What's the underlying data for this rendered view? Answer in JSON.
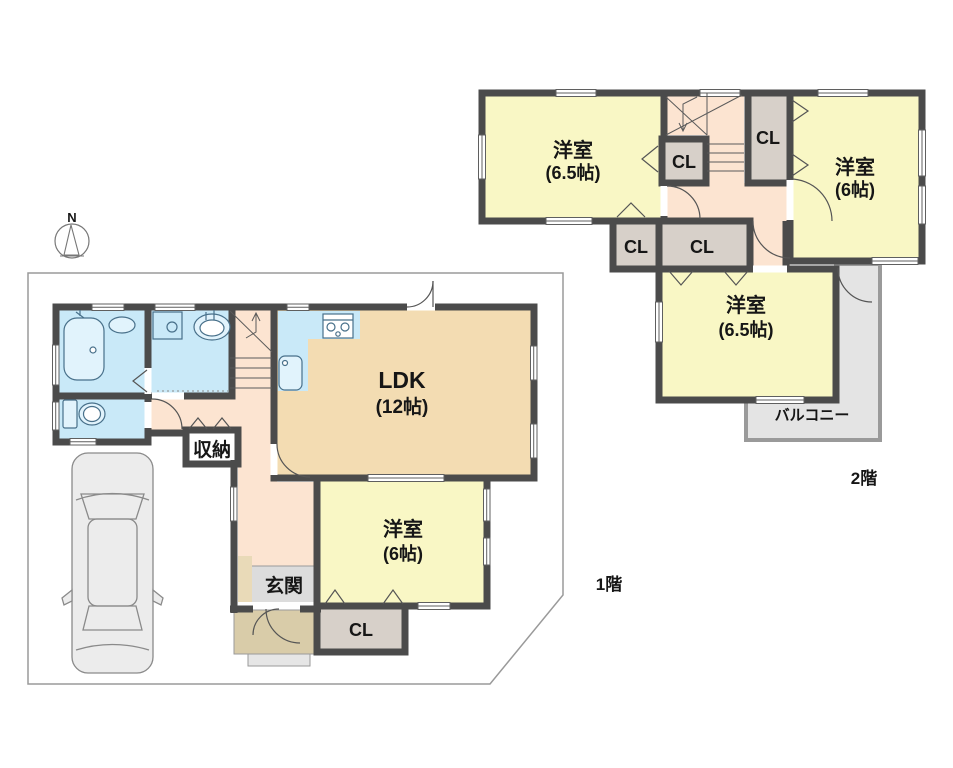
{
  "compass": {
    "north": "N"
  },
  "floor1": {
    "label": "1階",
    "ldk_name": "LDK",
    "ldk_size": "(12帖)",
    "bedroom_name": "洋室",
    "bedroom_size": "(6帖)",
    "entrance_label": "玄関",
    "storage_label": "収納",
    "closet_label": "CL"
  },
  "floor2": {
    "label": "2階",
    "room_tl_name": "洋室",
    "room_tl_size": "(6.5帖)",
    "room_tr_name": "洋室",
    "room_tr_size": "(6帖)",
    "room_b_name": "洋室",
    "room_b_size": "(6.5帖)",
    "closet_inner": "CL",
    "closet_top": "CL",
    "closet_mid1": "CL",
    "closet_mid2": "CL",
    "balcony_label": "バルコニー"
  },
  "colors": {
    "wall": "#4b4b4b",
    "room_yellow": "#f9f7c5",
    "ldk_tan": "#f3dcb2",
    "hall_pink": "#fce4d1",
    "water_blue": "#c9e9f8",
    "fixture_blue": "#e1f3fc",
    "closet_gray": "#d7d0c9",
    "balcony_gray": "#e4e4e4",
    "entrance_gray": "#dcdcdc",
    "porch_tan": "#d9cca9",
    "car_gray": "#ececec",
    "boundary": "#9a9a9a"
  }
}
